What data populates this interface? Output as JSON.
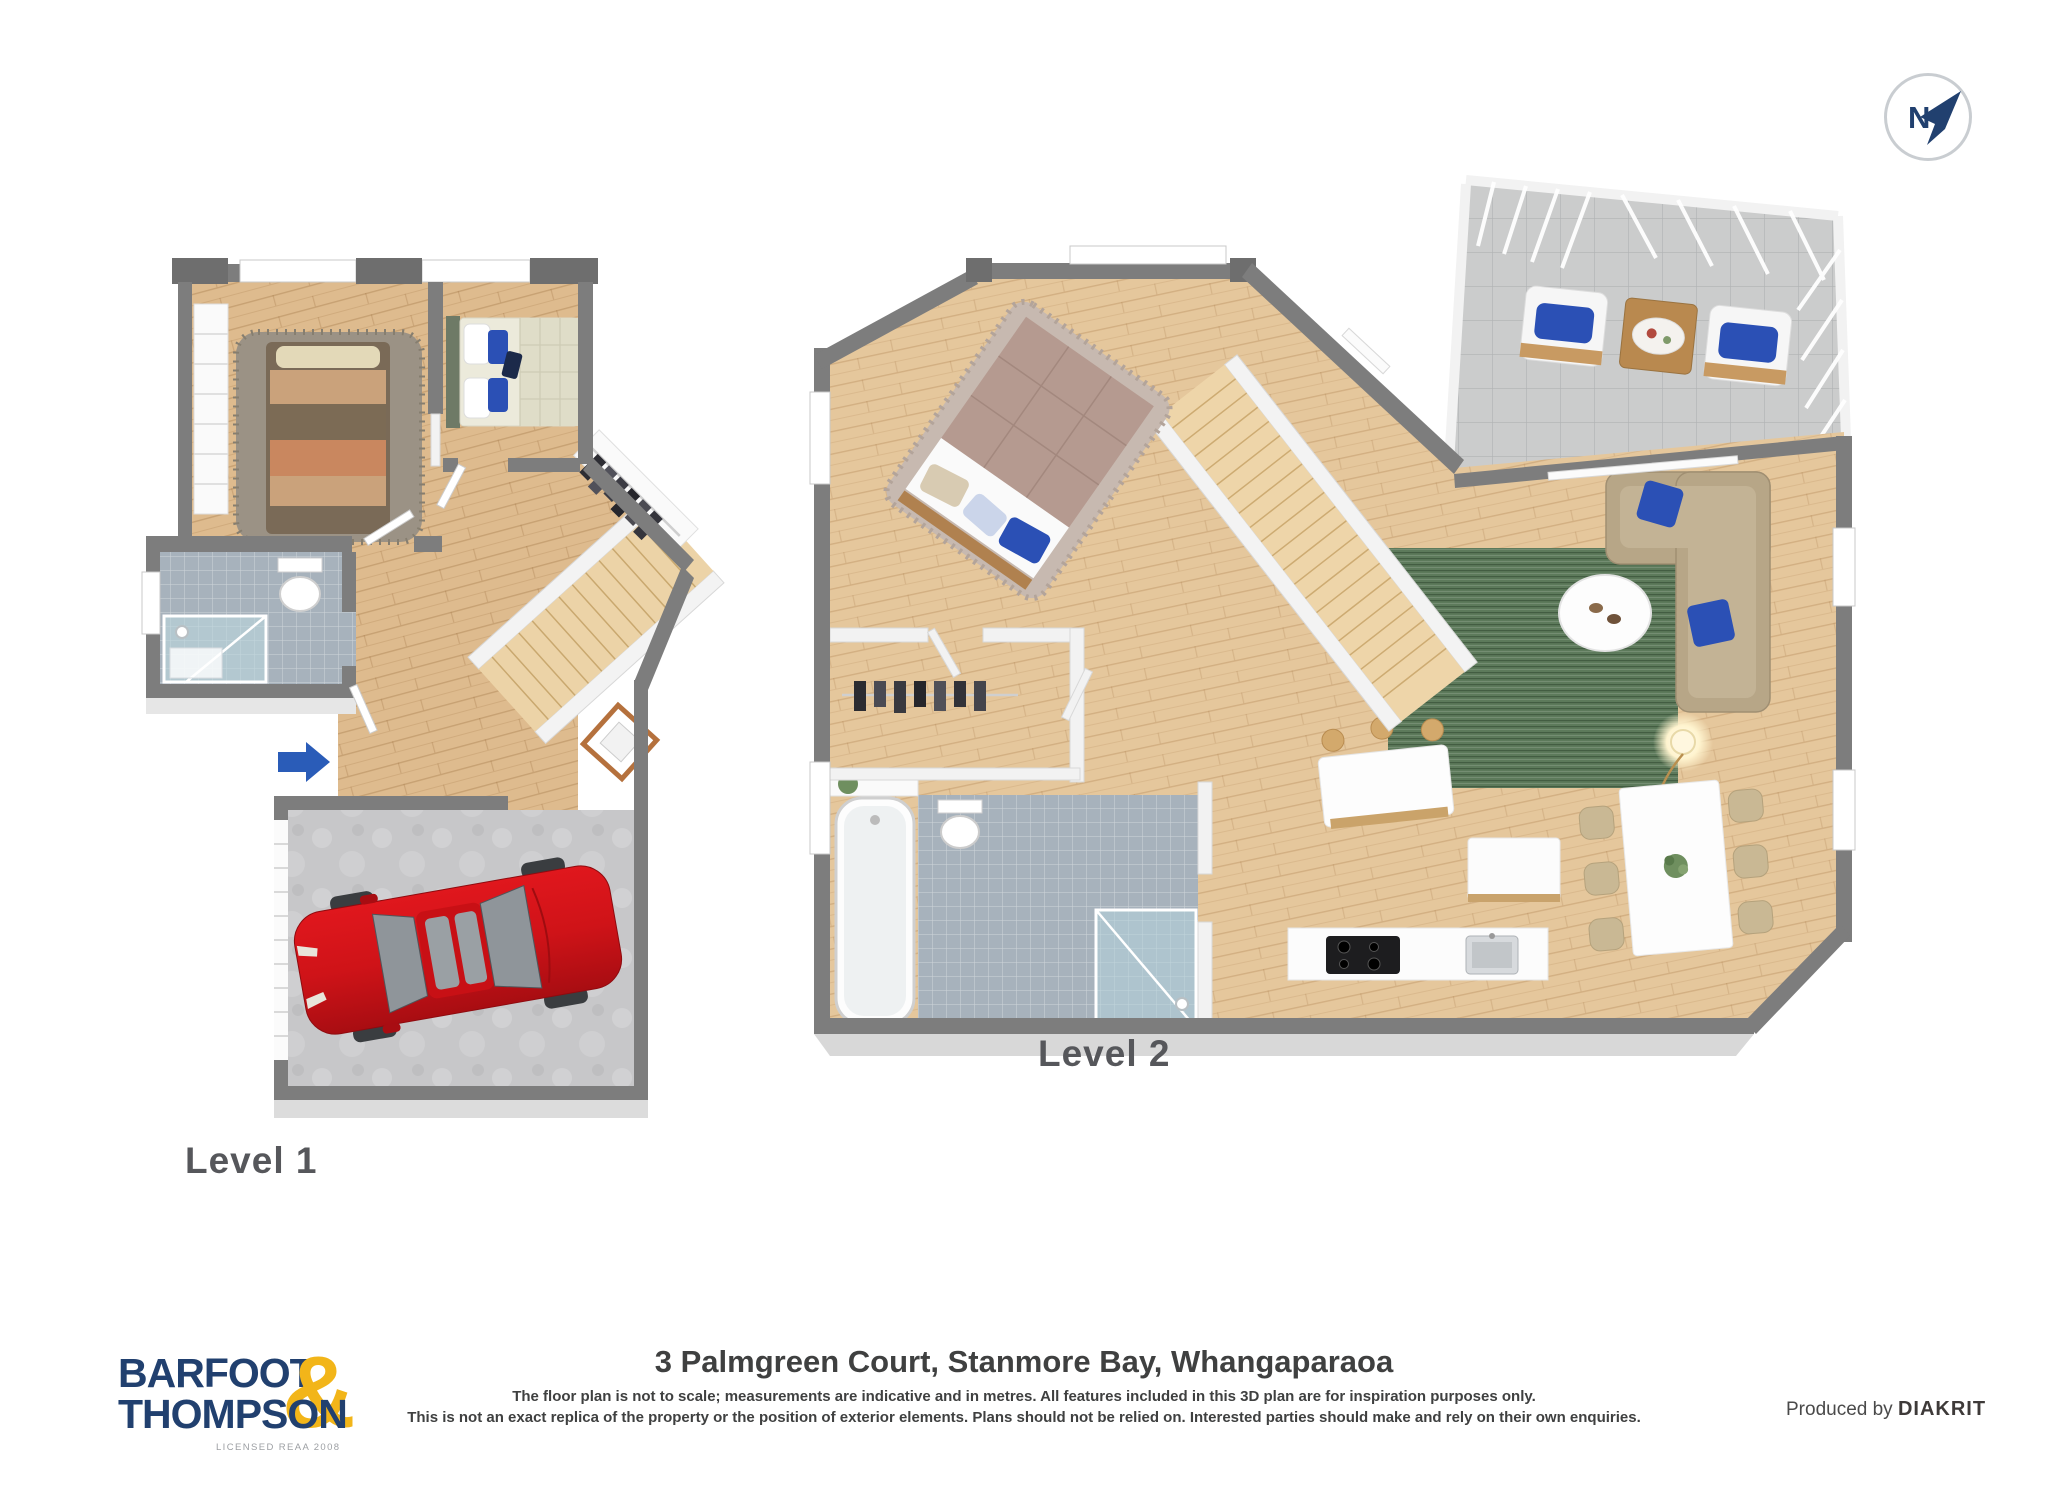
{
  "page": {
    "width_px": 2048,
    "height_px": 1494,
    "background": "#ffffff"
  },
  "colors": {
    "navy": "#21406f",
    "gold": "#f2b519",
    "accent-blue": "#2a5cb8",
    "car-red": "#cf1318",
    "wall-gray": "#7d7d7d",
    "wall-dark": "#6e6e6e",
    "wood": "#debb8e",
    "wood2": "#e5c79c",
    "tile-blue": "#a7b2bc",
    "concrete": "#c7c7c9",
    "balcony-tile": "#cbcccc",
    "rug-green": "#5d7a5b",
    "rug-gray": "#9b9285",
    "sofa-beige": "#b7a687",
    "pillow-blue": "#2b50b5",
    "bed-mauve": "#b59a90",
    "label-gray": "#56575b",
    "text-dark": "#3f4040",
    "compass-ring": "#c9cdd1"
  },
  "compass": {
    "label": "N"
  },
  "plans": [
    {
      "label": "Level 1"
    },
    {
      "label": "Level 2"
    }
  ],
  "footer": {
    "logo": {
      "line1": "BARFOOT",
      "ampersand": "&",
      "line2": "THOMPSON",
      "license": "LICENSED REAA 2008"
    },
    "address": "3 Palmgreen Court, Stanmore Bay, Whangaparaoa",
    "disclaimer_line1": "The floor plan is not to scale; measurements are indicative and in metres. All features included in this 3D plan are for inspiration purposes only.",
    "disclaimer_line2": "This is not an exact replica of the property or the position of exterior elements. Plans should not be relied on. Interested parties should make and rely on their own enquiries.",
    "produced_by": "Produced by",
    "producer": "DIAKRIT"
  }
}
